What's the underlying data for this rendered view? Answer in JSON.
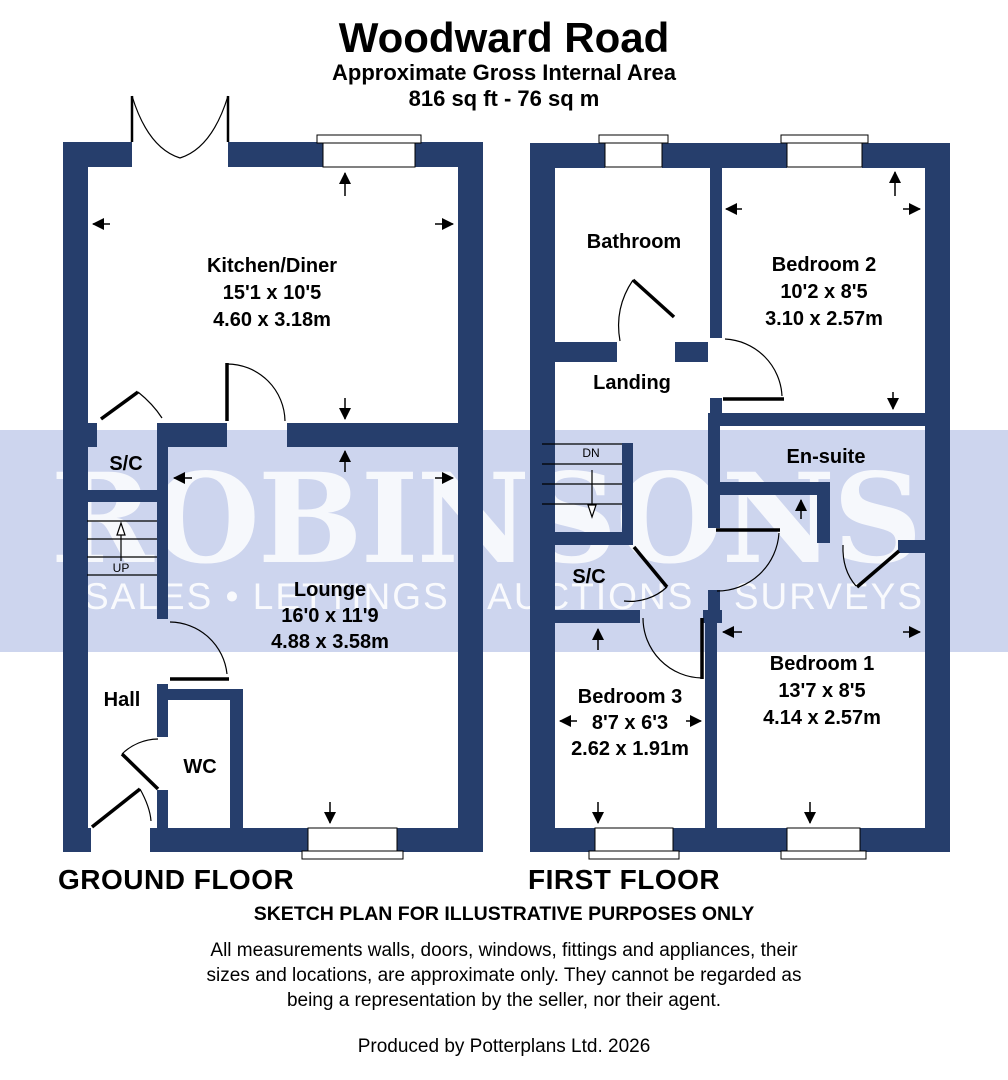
{
  "header": {
    "title": "Woodward Road",
    "subtitle": "Approximate Gross Internal Area",
    "area": "816 sq ft - 76 sq m"
  },
  "watermark": {
    "name": "ROBINSONS.",
    "tagline": "SALES • LETTINGS • AUCTIONS • SURVEYS",
    "band_color": "#CDD5EE",
    "text_color": "#FFFFFF"
  },
  "colors": {
    "wall": "#263E6C",
    "line": "#000000",
    "room_fill": "#FFFFFF"
  },
  "ground_floor": {
    "label": "GROUND FLOOR",
    "stairs_label": "UP",
    "rooms": {
      "kitchen": {
        "name": "Kitchen/Diner",
        "dims_ft": "15'1 x 10'5",
        "dims_m": "4.60 x 3.18m"
      },
      "sc": {
        "name": "S/C"
      },
      "lounge": {
        "name": "Lounge",
        "dims_ft": "16'0 x 11'9",
        "dims_m": "4.88 x 3.58m"
      },
      "hall": {
        "name": "Hall"
      },
      "wc": {
        "name": "WC"
      }
    }
  },
  "first_floor": {
    "label": "FIRST FLOOR",
    "stairs_label": "DN",
    "rooms": {
      "bathroom": {
        "name": "Bathroom"
      },
      "bedroom2": {
        "name": "Bedroom 2",
        "dims_ft": "10'2 x 8'5",
        "dims_m": "3.10 x 2.57m"
      },
      "landing": {
        "name": "Landing"
      },
      "ensuite": {
        "name": "En-suite"
      },
      "sc": {
        "name": "S/C"
      },
      "bedroom3": {
        "name": "Bedroom 3",
        "dims_ft": "8'7 x 6'3",
        "dims_m": "2.62 x 1.91m"
      },
      "bedroom1": {
        "name": "Bedroom 1",
        "dims_ft": "13'7 x 8'5",
        "dims_m": "4.14 x 2.57m"
      }
    }
  },
  "footer": {
    "disclaimer_title": "SKETCH PLAN FOR ILLUSTRATIVE PURPOSES ONLY",
    "disclaimer_lines": [
      "All measurements walls, doors, windows, fittings and appliances, their",
      "sizes and locations, are approximate only. They cannot be regarded as",
      "being a representation by the seller, nor their agent."
    ],
    "credit": "Produced by Potterplans Ltd. 2026"
  }
}
